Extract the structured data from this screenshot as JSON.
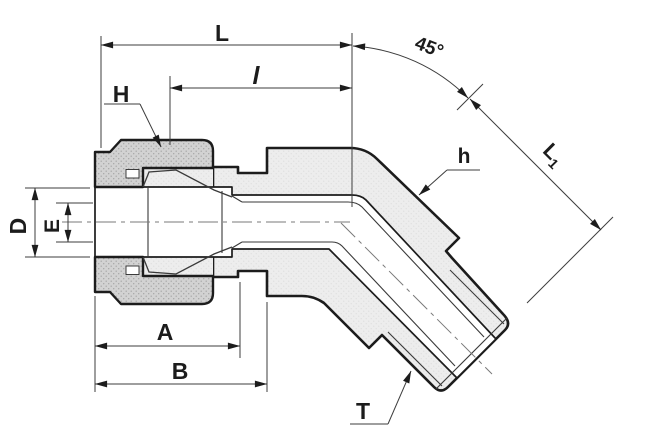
{
  "drawing": {
    "background": "#ffffff",
    "outline_color": "#1c1c1c",
    "dimension_color": "#3d3d3d",
    "body_fill": "#ececec",
    "nut_fill": "#d2d2d2",
    "labels": {
      "overall_length": "L",
      "insertion_length": "l",
      "bend_angle": "45°",
      "nut_hex": "H",
      "body_hex": "h",
      "angled_length_main": "L",
      "angled_length_sub": "1",
      "diameter_d": "D",
      "diameter_e": "E",
      "dim_a": "A",
      "dim_b": "B",
      "thread": "T"
    }
  }
}
